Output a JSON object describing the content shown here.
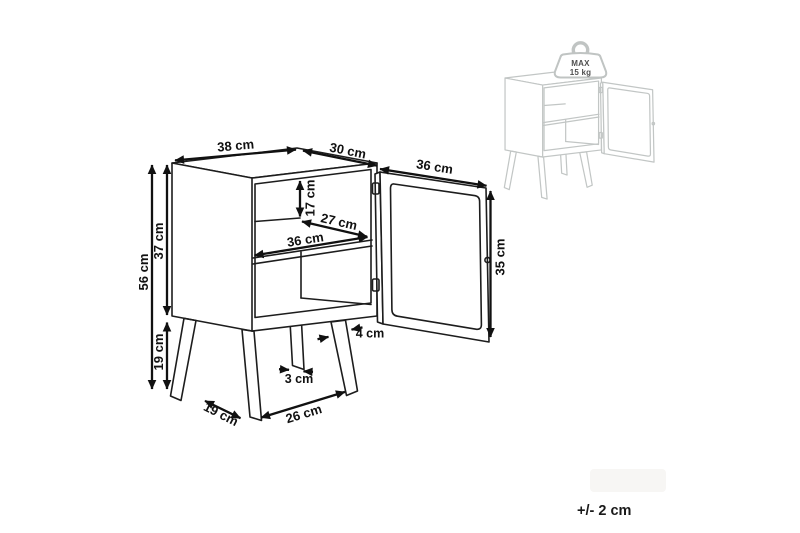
{
  "page": {
    "background": "#ffffff",
    "line_color": "#1d1d1d",
    "dimension_color": "#111111",
    "ghost_color": "#c2c6c5",
    "tolerance_note": "+/- 2 cm"
  },
  "main_diagram": {
    "subject": "bedside-cabinet-with-open-door",
    "dimensions": {
      "top_width": "38 cm",
      "top_depth": "30 cm",
      "door_open_width": "36 cm",
      "upper_compartment_height": "17 cm",
      "interior_depth": "27 cm",
      "interior_width": "36 cm",
      "door_height": "35 cm",
      "total_height": "56 cm",
      "body_height": "37 cm",
      "leg_height": "19 cm",
      "leg_top_thickness": "4 cm",
      "leg_foot_thickness": "3 cm",
      "front_leg_spacing": "26 cm",
      "side_leg_spacing": "19 cm"
    }
  },
  "max_load_inset": {
    "line1": "MAX",
    "line2": "15 kg"
  }
}
